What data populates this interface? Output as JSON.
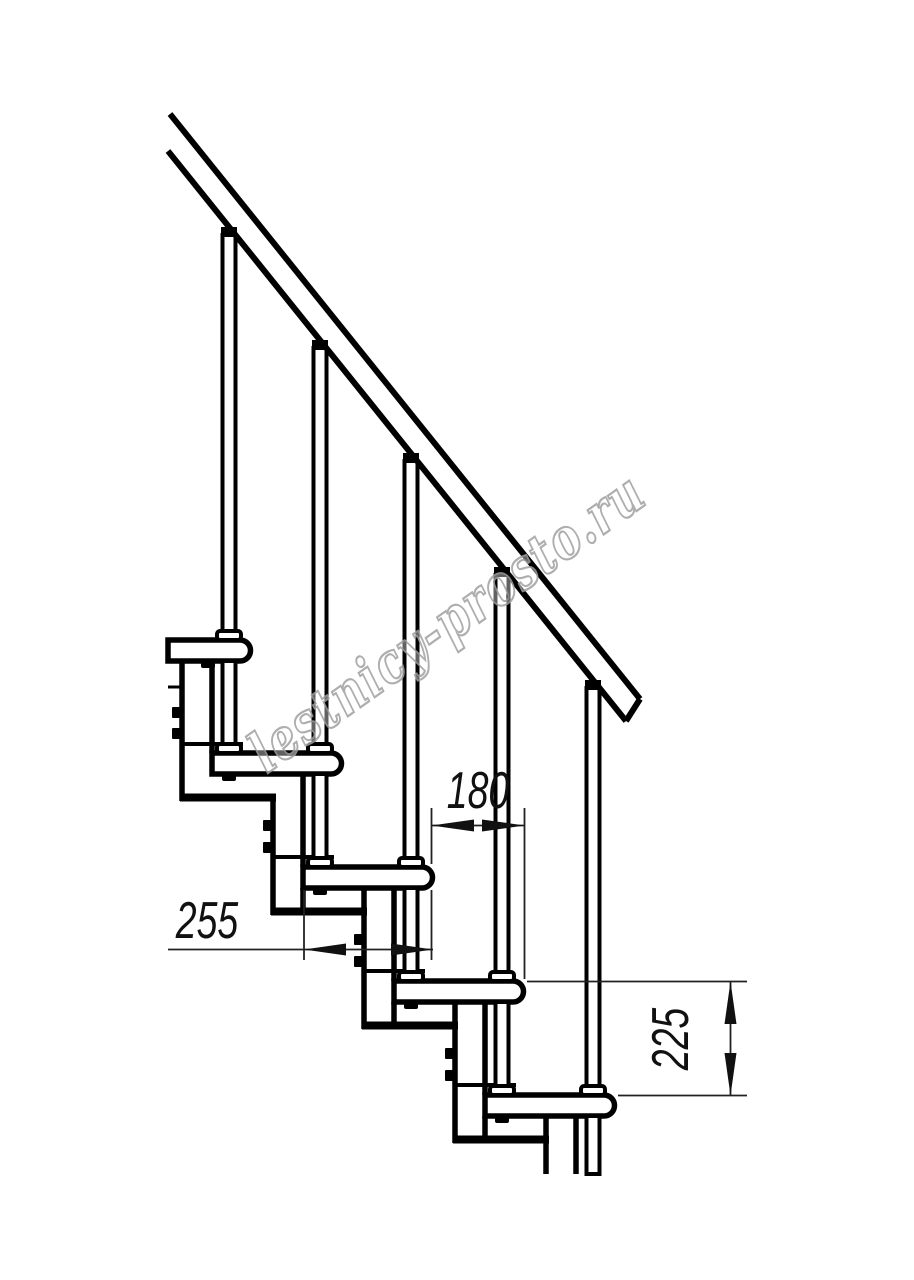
{
  "drawing": {
    "watermark": "lestnicy-prosto.ru",
    "dimension_labels": {
      "step_run": "180",
      "tread_depth": "255",
      "step_rise": "225"
    },
    "colors": {
      "line": "#000000",
      "dimension": "#222222",
      "watermark_outline": "#a0a0a0",
      "background": "#ffffff"
    }
  }
}
